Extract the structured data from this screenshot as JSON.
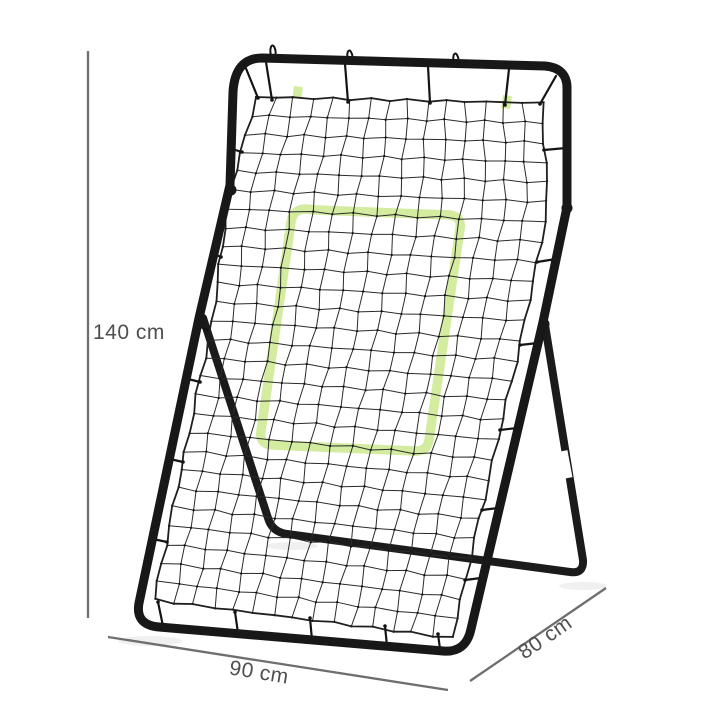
{
  "image": {
    "description": "Rebounder pitchback net product photo with dimension annotations",
    "background": "#ffffff"
  },
  "colors": {
    "frame": "#181818",
    "support": "#1b1b1b",
    "net_line": "#2b2b2b",
    "net_border": "#1f1f1f",
    "knot": "#111111",
    "tie": "#141414",
    "strike_zone": "#cbe98f",
    "sleeve": "#ffffff",
    "dim_line": "#6e6e6e",
    "dim_text": "#4f4f4f",
    "shadow": "#f0f0f0"
  },
  "dimensions": {
    "height_label": "140 cm",
    "width_label": "90 cm",
    "depth_label": "80 cm"
  }
}
